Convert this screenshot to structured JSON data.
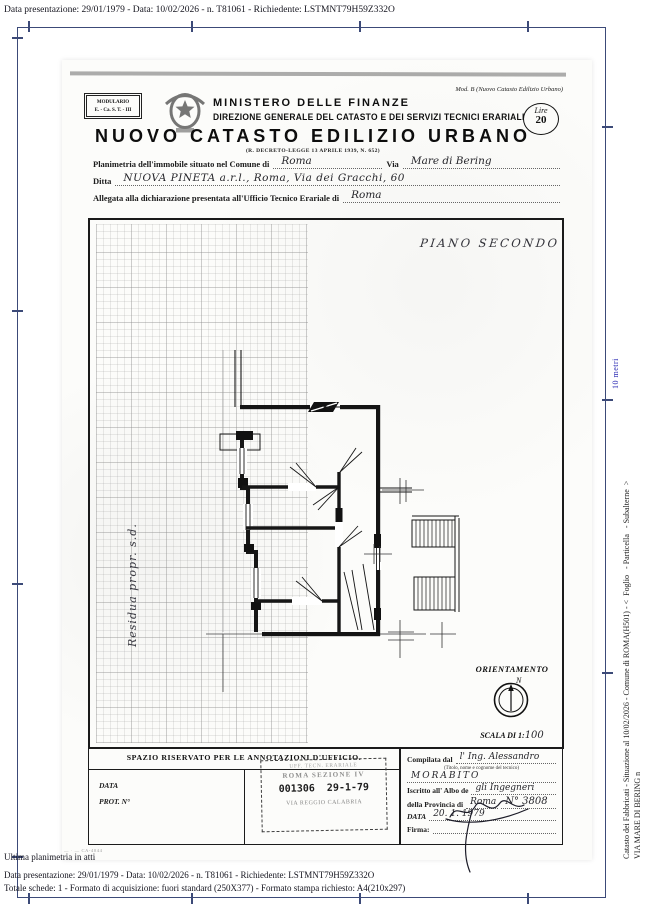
{
  "colors": {
    "frame": "#3c4a78",
    "ruler_label": "#2b2bb4"
  },
  "viewer": {
    "top_status": "Data presentazione: 29/01/1979 - Data: 10/02/2026 - n. T81061 - Richiedente: LSTMNT79H59Z332O",
    "ruler_label": "10 metri",
    "side_line1": "Catasto dei Fabbricati - Situazione al 10/02/2026 - Comune di ROMA(H501) - <  Foglio   - Particella   - Subalterne  >",
    "side_line2": "VIA MARE DI BERING n",
    "footer_note": "Ultima planimetria in atti",
    "footer_line1": "Data presentazione: 29/01/1979 - Data: 10/02/2026 - n. T81061 - Richiedente: LSTMNT79H59Z332O",
    "footer_line2": "Totale schede: 1 - Formato di acquisizione: fuori standard (250X377) - Formato stampa richiesto: A4(210x297)"
  },
  "form": {
    "modulario_line1": "MODULARIO",
    "modulario_line2": "E. - Ca. S. T. - III",
    "mod_note": "Mod. B (Nuovo Catasto Edilizio Urbano)",
    "ministry_line1": "MINISTERO DELLE FINANZE",
    "ministry_line2": "DIREZIONE GENERALE DEL CATASTO E DEI SERVIZI TECNICI ERARIALI",
    "title": "NUOVO CATASTO EDILIZIO URBANO",
    "law_ref": "(R. DECRETO-LEGGE 13 APRILE 1939, N. 652)",
    "lire_label": "Lire",
    "lire_value": "20",
    "field1_label": "Planimetria dell'immobile situato nel Comune di",
    "field1_value": "Roma",
    "field1b_label": "Via",
    "field1b_value": "Mare di Bering",
    "field2_label": "Ditta",
    "field2_value": "NUOVA PINETA a.r.l., Roma, Via dei Gracchi, 60",
    "field3_label": "Allegata alla dichiarazione presentata all'Ufficio Tecnico Erariale di",
    "field3_value": "Roma",
    "plan": {
      "floor_label": "PIANO SECONDO",
      "margin_note": "Residua propr. s.d.",
      "orientation_title": "ORIENTAMENTO",
      "north": "N",
      "scale_label": "SCALA DI 1:",
      "scale_value": "100"
    },
    "office": {
      "header": "SPAZIO RISERVATO PER LE ANNOTAZIONI D'UFFICIO.",
      "data_label": "DATA",
      "prot_label": "PROT. N°",
      "stamp_line1": "UFF. TECN. ERARIALE",
      "stamp_line2": "ROMA SEZIONE IV",
      "stamp_line3": "001306  29-1-79",
      "stamp_line4": "VIA REGGIO CALABRIA"
    },
    "compiler": {
      "label_compilata": "Compilata dal",
      "value_compilata": "l' Ing. Alessandro",
      "caption": "(Titolo, nome e cognome del tecnico)",
      "value_surname": "MORABITO",
      "label_iscritto": "Iscritto all' Albo de",
      "value_iscritto": "gli Ingegneri",
      "label_provincia": "della Provincia di",
      "value_provincia": "Roma",
      "value_number": "N° 3808",
      "label_data": "DATA",
      "value_data": "20. 1. 1979",
      "label_firma": "Firma:"
    },
    "printer_mark": "— · — CA-4044"
  }
}
